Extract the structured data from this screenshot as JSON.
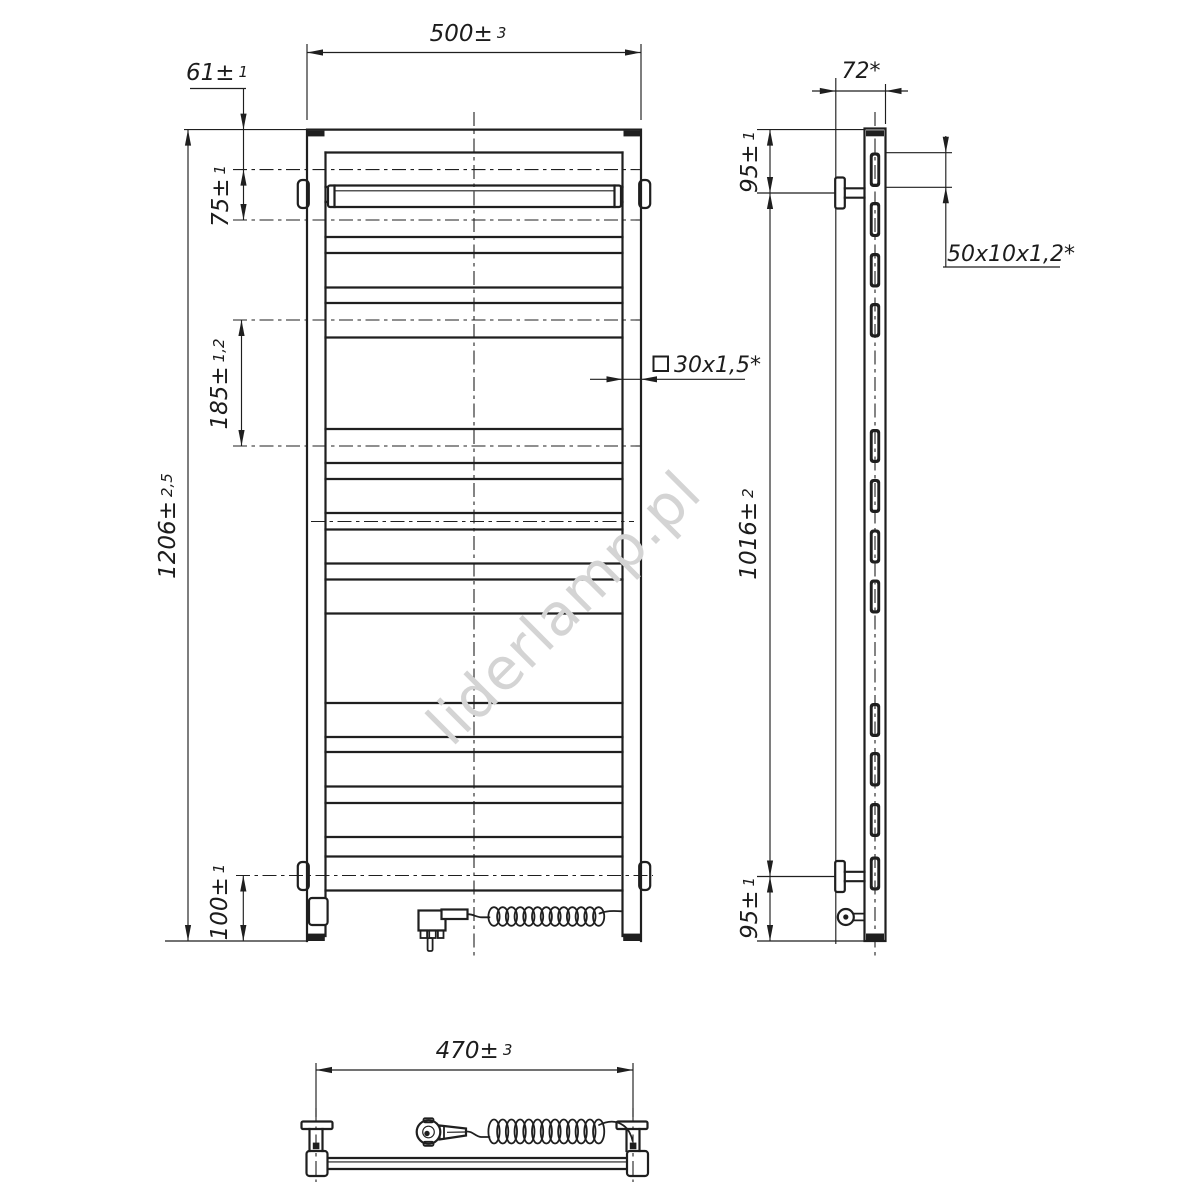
{
  "watermark": {
    "text": "liderlamp.pl",
    "color": "#d4d4d4",
    "angle_deg": -45
  },
  "drawing": {
    "type": "towel-radiator technical drawing",
    "views": [
      "front-view",
      "side-view",
      "bottom-view"
    ],
    "line_color": "#1f1f1f",
    "background": "#ffffff"
  },
  "dimensions": {
    "total_width": {
      "value": "500",
      "tol": "3"
    },
    "hanger_axis_from_top": {
      "value": "61",
      "tol": "1"
    },
    "hanger_to_first_rung": {
      "value": "75",
      "tol": "1"
    },
    "rung_group_span": {
      "value": "185",
      "tol": "1,2"
    },
    "total_height": {
      "value": "1206",
      "tol": "2,5"
    },
    "element_axis_from_bottom": {
      "value": "100",
      "tol": "1"
    },
    "post_profile": {
      "value": "30x1,5*",
      "tol": ""
    },
    "mounting_depth": {
      "value": "72*",
      "tol": ""
    },
    "bracket_axis_from_top": {
      "value": "95",
      "tol": "1"
    },
    "rung_profile": {
      "value": "50x10x1,2*",
      "tol": ""
    },
    "bracket_span": {
      "value": "1016",
      "tol": "2"
    },
    "bracket_axis_from_bottom": {
      "value": "95",
      "tol": "1"
    },
    "bracket_centers_width": {
      "value": "470",
      "tol": "3"
    }
  },
  "geometry": {
    "front": {
      "frame": {
        "left": 307,
        "right": 641,
        "top": 129.6,
        "bottom": 941,
        "inner_left": 325.5,
        "inner_right": 622.5
      },
      "rungs": [
        [
          152.5,
          187
        ],
        [
          202,
          237
        ],
        [
          253,
          287.5
        ],
        [
          303,
          337.5
        ],
        [
          429,
          463
        ],
        [
          479,
          513
        ],
        [
          529.5,
          563.5
        ],
        [
          579.5,
          613.5
        ],
        [
          703,
          737
        ],
        [
          752,
          786.5
        ],
        [
          803,
          837
        ],
        [
          856.5,
          890.5
        ]
      ],
      "axes": [
        {
          "y": 169.6,
          "x1": 233,
          "x2": 642
        },
        {
          "y": 220.0,
          "x1": 233,
          "x2": 642
        },
        {
          "y": 320.0,
          "x1": 233,
          "x2": 642
        },
        {
          "y": 446.0,
          "x1": 233,
          "x2": 642
        },
        {
          "y": 521.5,
          "x1": 311,
          "x2": 634
        },
        {
          "y": 875.5,
          "x1": 236,
          "x2": 653
        }
      ],
      "center_x": 474,
      "hanger": {
        "x": 328,
        "y": 185.5,
        "w": 293,
        "h": 21.5
      },
      "tabs": [
        [
          297.8,
          180
        ],
        [
          297.8,
          862
        ],
        [
          639.2,
          180
        ],
        [
          639.2,
          862
        ]
      ],
      "heater_box": {
        "x": 309,
        "y": 898,
        "w": 18.6,
        "h": 27
      }
    },
    "side": {
      "wall_x": 835.8,
      "tube_x": 864.5,
      "tube_w": 21,
      "center_x": 875,
      "bracket_axes": [
        193,
        876.5
      ]
    },
    "bottom": {
      "bar": {
        "x1": 327.5,
        "x2": 627.5,
        "y1": 1158,
        "y2": 1169
      },
      "bracket_axes_x": [
        316,
        633
      ]
    },
    "coil": {
      "n": 13,
      "x0": 494,
      "step": 8.72,
      "rx": 5.6,
      "front_cy": 916.5,
      "front_ry": 9.3,
      "bottom_cy": 1131.5,
      "bottom_ry": 12
    }
  }
}
